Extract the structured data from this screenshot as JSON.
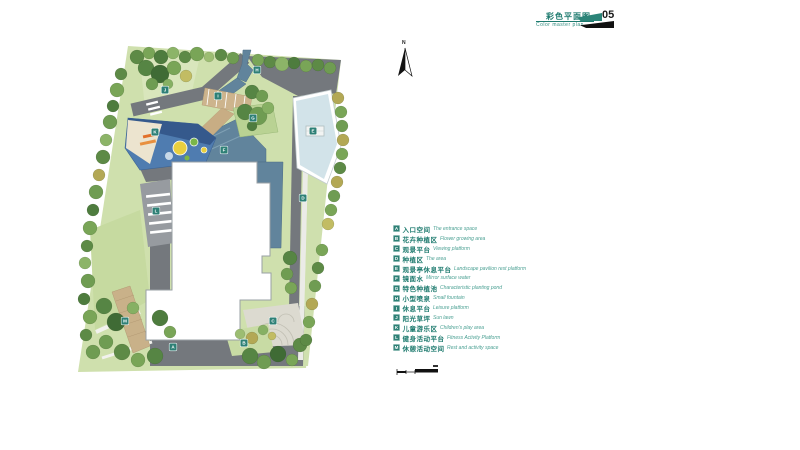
{
  "header": {
    "title_cn": "彩色平面图",
    "title_en": "Color master plan",
    "page_number": "05"
  },
  "compass": {
    "label": "N"
  },
  "legend": {
    "items": [
      {
        "key": "A",
        "cn": "入口空间",
        "en": "The entrance space"
      },
      {
        "key": "B",
        "cn": "花卉种植区",
        "en": "Flower growing area"
      },
      {
        "key": "C",
        "cn": "观景平台",
        "en": "Viewing platform"
      },
      {
        "key": "D",
        "cn": "种植区",
        "en": "The area"
      },
      {
        "key": "E",
        "cn": "观景亭休息平台",
        "en": "Landscape pavilion rest platform"
      },
      {
        "key": "F",
        "cn": "镜面水",
        "en": "Mirror surface water"
      },
      {
        "key": "G",
        "cn": "特色种植池",
        "en": "Characteristic planting pond"
      },
      {
        "key": "H",
        "cn": "小型喷泉",
        "en": "Small fountain"
      },
      {
        "key": "I",
        "cn": "休息平台",
        "en": "Leisure platform"
      },
      {
        "key": "J",
        "cn": "阳光草坪",
        "en": "Sun lawn"
      },
      {
        "key": "K",
        "cn": "儿童游乐区",
        "en": "Children's play area"
      },
      {
        "key": "L",
        "cn": "健身活动平台",
        "en": "Fitness Activity Platform"
      },
      {
        "key": "M",
        "cn": "休憩活动空间",
        "en": "Rest and activity space"
      }
    ]
  },
  "plan": {
    "markers": [
      {
        "key": "A",
        "x": 173,
        "y": 347
      },
      {
        "key": "B",
        "x": 244,
        "y": 343
      },
      {
        "key": "C",
        "x": 273,
        "y": 321
      },
      {
        "key": "D",
        "x": 303,
        "y": 198
      },
      {
        "key": "E",
        "x": 313,
        "y": 131
      },
      {
        "key": "F",
        "x": 224,
        "y": 150
      },
      {
        "key": "G",
        "x": 253,
        "y": 118
      },
      {
        "key": "H",
        "x": 257,
        "y": 70
      },
      {
        "key": "I",
        "x": 218,
        "y": 96
      },
      {
        "key": "J",
        "x": 165,
        "y": 90
      },
      {
        "key": "K",
        "x": 155,
        "y": 132
      },
      {
        "key": "L",
        "x": 156,
        "y": 211
      },
      {
        "key": "M",
        "x": 125,
        "y": 321
      }
    ]
  },
  "colors": {
    "accent_teal": "#2e8076",
    "legend_cn_text": "#1d7a6e",
    "legend_en_text": "#4ba093",
    "lawn": "#cfe0ad",
    "path_gray": "#74787d",
    "water": "#61849c",
    "pool": "#d2e3e9",
    "deck": "#cdb48d",
    "play_ground": "#4f7cb0",
    "page_number_black": "#111111"
  }
}
